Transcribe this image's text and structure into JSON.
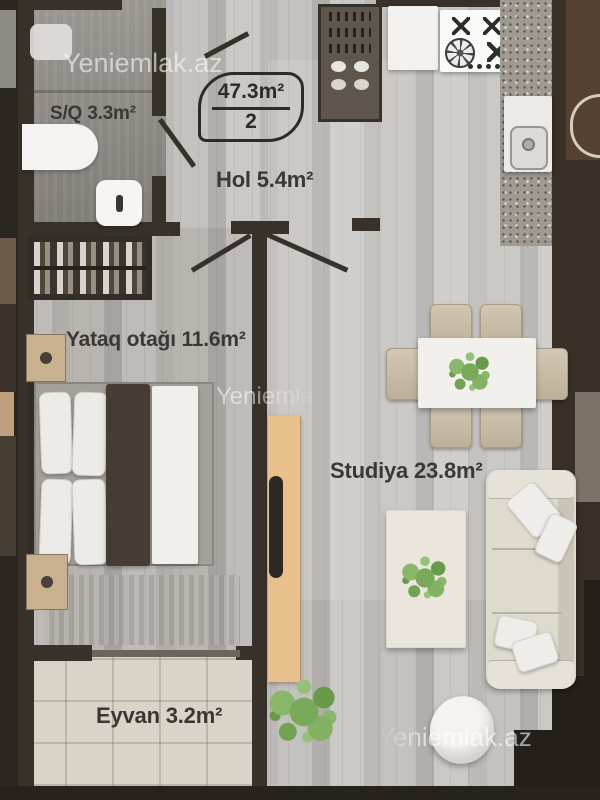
{
  "watermarks": {
    "top": "Yeniemlak.az",
    "middle": "Yeniemlak.az",
    "bottom": "Yeniemlak.az"
  },
  "area_badge": {
    "total_area": "47.3m²",
    "unit_count": "2"
  },
  "rooms": {
    "bathroom": {
      "label": "S/Q 3.3m²"
    },
    "hall": {
      "label": "Hol 5.4m²"
    },
    "bedroom": {
      "label": "Yataq otağı 11.6m²"
    },
    "studio": {
      "label": "Studiya 23.8m²"
    },
    "balcony": {
      "label": "Eyvan 3.2m²"
    }
  },
  "colors": {
    "wall": "#37312a",
    "floor_wood": "#c4c2bf",
    "floor_tile": "#d9d3c8",
    "bathroom_floor": "#8f8b86",
    "tv_console_wood": "#e9bf8b",
    "label_text": "#3b3834",
    "plant_green": "#79a95a",
    "dark_brown_band": "#382f27"
  }
}
